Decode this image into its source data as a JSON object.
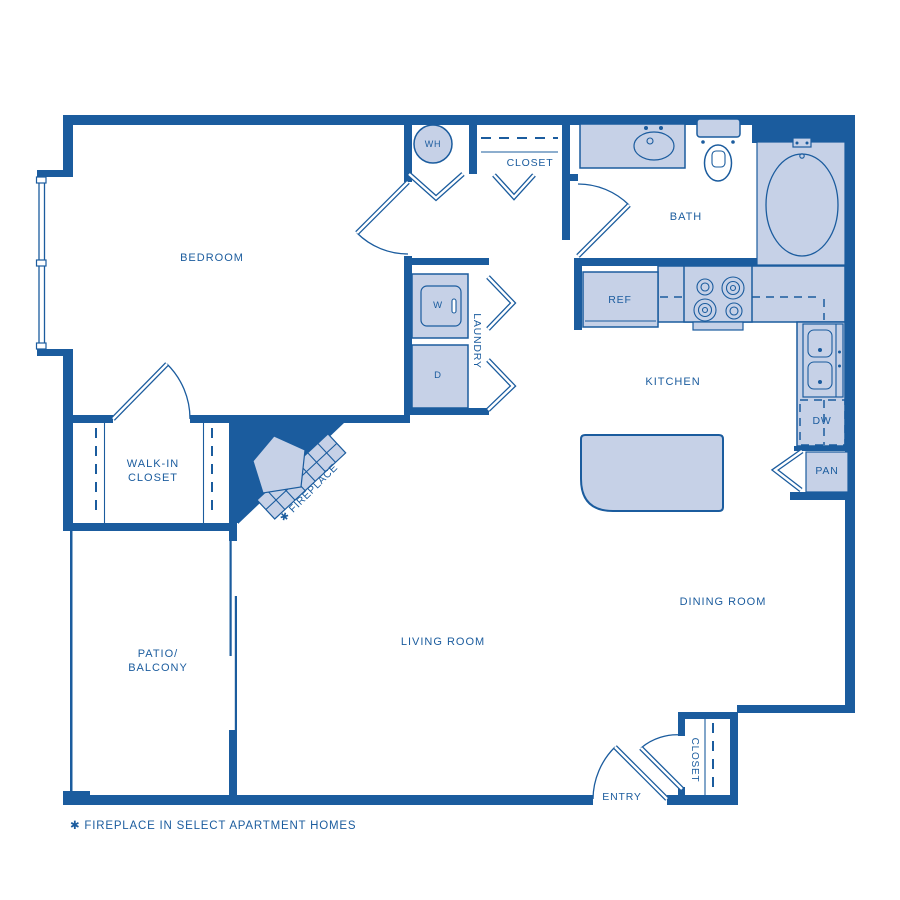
{
  "colors": {
    "wall": "#1b5c9e",
    "fixture_fill": "#c6d1e7",
    "text": "#1b5c9e",
    "background": "#ffffff"
  },
  "labels": {
    "bedroom": "BEDROOM",
    "walk_in_closet_line1": "WALK-IN",
    "walk_in_closet_line2": "CLOSET",
    "patio_line1": "PATIO/",
    "patio_line2": "BALCONY",
    "living_room": "LIVING ROOM",
    "dining_room": "DINING ROOM",
    "kitchen": "KITCHEN",
    "bath": "BATH",
    "entry": "ENTRY",
    "laundry": "LAUNDRY",
    "hall_closet": "CLOSET",
    "entry_closet": "CLOSET",
    "water_heater": "WH",
    "washer": "W",
    "dryer": "D",
    "refrigerator": "REF",
    "dishwasher": "DW",
    "pantry": "PAN",
    "fireplace": "✱ FIREPLACE",
    "footnote": "✱  FIREPLACE IN SELECT APARTMENT HOMES"
  }
}
